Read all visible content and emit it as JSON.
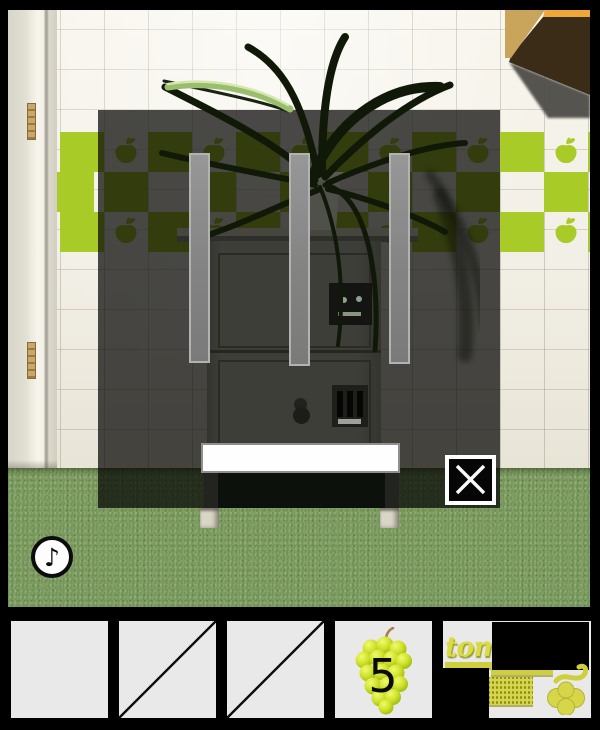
{
  "meta": {
    "app": "escape-game",
    "view": "kitchen-cabinet-zoom",
    "width": 600,
    "height": 730
  },
  "scene": {
    "music_button": {
      "glyph": "♪"
    },
    "popup": {
      "bar_count": 3,
      "close_icon": "x-cross"
    },
    "palette": {
      "tile_green": "#a9cb28",
      "carpet_green": "#7d9d61",
      "wall_cream": "#f2efe6",
      "wood_tan": "#c9a45b",
      "overlay": "rgba(4,4,3,0.72)"
    }
  },
  "inventory": {
    "slots": [
      {
        "id": "slot-1",
        "state": "empty"
      },
      {
        "id": "slot-2",
        "state": "used"
      },
      {
        "id": "slot-3",
        "state": "used"
      },
      {
        "id": "slot-4",
        "state": "item",
        "item": "green-grapes",
        "count": "5"
      },
      {
        "id": "slot-5",
        "state": "credit",
        "visible_text": "tom"
      }
    ]
  }
}
